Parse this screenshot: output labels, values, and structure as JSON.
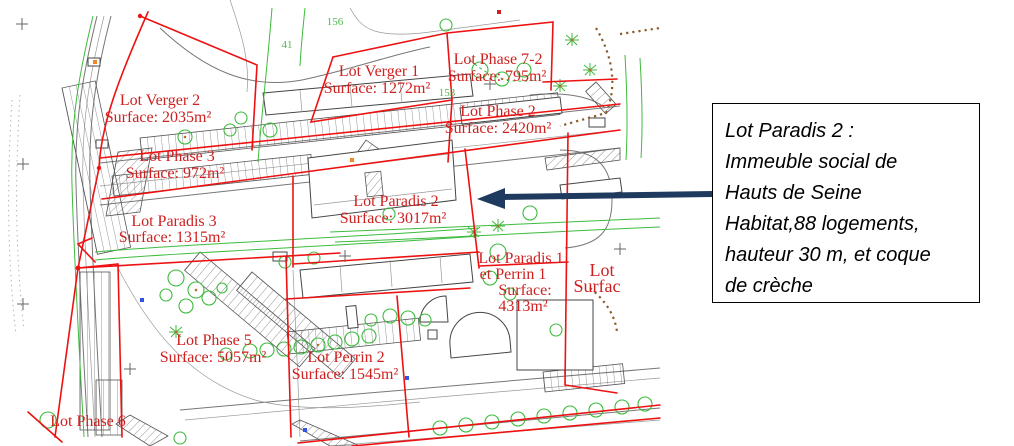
{
  "map": {
    "lots": [
      {
        "lines": [
          "Lot Verger 2",
          "Surface: 2035m²"
        ]
      },
      {
        "lines": [
          "Lot Verger 1",
          "Surface: 1272m²"
        ]
      },
      {
        "lines": [
          "Lot Phase 7-2",
          "Surface: 795m²"
        ]
      },
      {
        "lines": [
          "Lot Phase 2",
          "Surface: 2420m²"
        ]
      },
      {
        "lines": [
          "Lot Phase 3",
          "Surface: 972m²"
        ]
      },
      {
        "lines": [
          "Lot Paradis 2",
          "Surface: 3017m²"
        ]
      },
      {
        "lines": [
          "Lot Paradis 3",
          "Surface: 1315m²"
        ]
      },
      {
        "lines": [
          "Lot Paradis 1",
          "et Perrin 1",
          "Surface:",
          "4313m²"
        ]
      },
      {
        "lines": [
          "Lot",
          "Surfac"
        ]
      },
      {
        "lines": [
          "Lot Phase 5",
          "Surface: 5057m²"
        ]
      },
      {
        "lines": [
          "Lot Perrin 2",
          "Surface: 1545m²"
        ]
      },
      {
        "lines": [
          "Lot Phase 6"
        ]
      }
    ],
    "survey_labels": {
      "g41": "41",
      "g156": "156",
      "g153": "153"
    }
  },
  "callout": {
    "lines": [
      "Lot Paradis 2 :",
      "Immeuble social de",
      "Hauts de Seine",
      "Habitat,88 logements,",
      "hauteur 30 m, et coque",
      "de crèche"
    ]
  },
  "colors": {
    "lot_boundary_red": "#ee1111",
    "lot_label_red": "#cf2020",
    "vegetation_green": "#3dbb3d",
    "pool_teal": "#2fa690",
    "path_dots_brown": "#8a5a2b",
    "callout_arrow_navy": "#1f3a5f",
    "road_gray": "#777"
  }
}
